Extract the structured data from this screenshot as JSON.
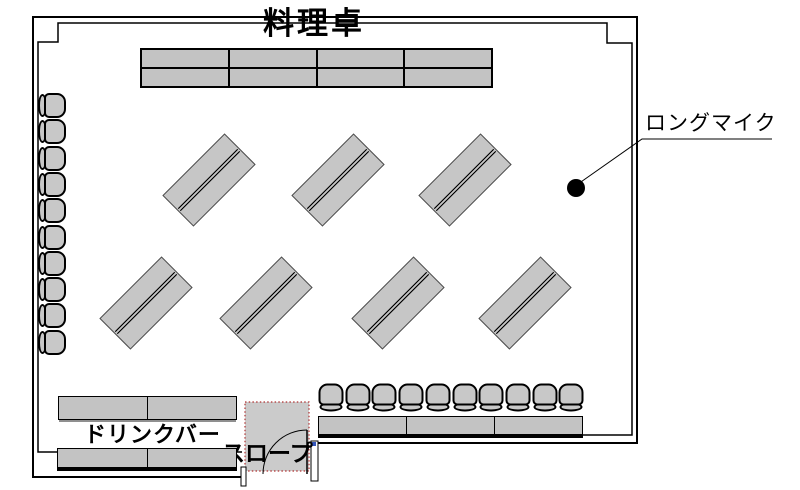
{
  "page": {
    "width": 800,
    "height": 490,
    "background": "#ffffff"
  },
  "title": "料理卓",
  "labels": {
    "long_mic": "ロングマイク",
    "drink_bar": "ドリンクバー",
    "slope": "スロープ"
  },
  "colors": {
    "wall": "#000000",
    "table_fill": "#c3c3c3",
    "diagonal_table_fill": "#c6c6c6",
    "chair_fill": "#c8c8c8",
    "door_fill": "#cbcbcb",
    "door_dotted_border": "#b03030",
    "grip_handle": "#3355bb",
    "mic_dot": "#000000",
    "text": "#000000"
  },
  "furniture": {
    "banquet_table": {
      "x": 140,
      "y": 48,
      "w": 353,
      "h": 40,
      "cols": 4,
      "rows": 2,
      "divider": 2
    },
    "diagonal_tables": {
      "w": 88,
      "h": 44,
      "angle_deg": -45,
      "centers": [
        [
          209,
          180
        ],
        [
          338,
          180
        ],
        [
          465,
          180
        ],
        [
          146,
          303
        ],
        [
          266,
          303
        ],
        [
          398,
          303
        ],
        [
          525,
          303
        ]
      ]
    },
    "left_chairs": {
      "count": 10,
      "x": 38,
      "y_start": 92,
      "pitch": 26.3
    },
    "bottom_chairs": {
      "count": 10,
      "x_start": 317,
      "y": 384,
      "pitch": 26.7
    },
    "stage_table": {
      "x": 318,
      "y": 416,
      "w": 265,
      "h": 22,
      "cols": 3,
      "rows": 1,
      "divider": 1
    },
    "drink_table_upper": {
      "x": 58,
      "y": 396,
      "w": 179,
      "h": 24,
      "cols": 2,
      "rows": 1,
      "divider": 1
    },
    "drink_table_lower": {
      "x": 57,
      "y": 448,
      "w": 180,
      "h": 23,
      "cols": 2,
      "rows": 1,
      "divider": 1
    },
    "door": {
      "x": 245,
      "y": 402,
      "w": 64,
      "h": 69
    },
    "mic_dot": {
      "cx": 576,
      "cy": 188,
      "r": 9
    }
  }
}
